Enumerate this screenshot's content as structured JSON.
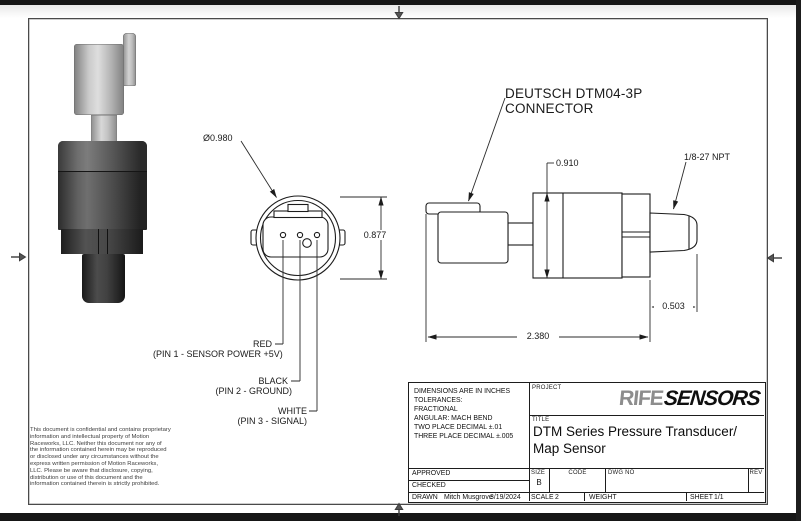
{
  "colors": {
    "line": "#1c1c1c",
    "dim_line": "#2b2b2b",
    "logo_part1": "#8d8d8d",
    "logo_part2": "#0f0f0f"
  },
  "callouts": {
    "diameter": "Ø0.980",
    "front_height": "0.877",
    "connector_line1": "DEUTSCH DTM04-3P",
    "connector_line2": "CONNECTOR",
    "body_height": "0.910",
    "thread": "1/8-27 NPT",
    "thread_length": "0.503",
    "overall_length": "2.380"
  },
  "pins": {
    "pin1_color": "RED",
    "pin1_desc": "(PIN 1 - SENSOR POWER +5V)",
    "pin2_color": "BLACK",
    "pin2_desc": "(PIN 2 - GROUND)",
    "pin3_color": "WHITE",
    "pin3_desc": "(PIN 3 - SIGNAL)"
  },
  "disclaimer": "This document is confidential and contains proprietary information and intellectual property of Motion Raceworks, LLC. Neither this document nor any of the information contained herein may be reproduced or disclosed under any circumstances without the express written permission of Motion Raceworks, LLC. Please be aware that disclosure, copying, distribution or use of this document and the information contained therein is strictly prohibited.",
  "title_block": {
    "tolerance_lines": [
      "DIMENSIONS ARE IN INCHES",
      "TOLERANCES:",
      "FRACTIONAL",
      "ANGULAR: MACH BEND",
      "TWO PLACE DECIMAL ±.01",
      "THREE PLACE DECIMAL ±.005"
    ],
    "project_label": "PROJECT",
    "logo_part1": "RIFE",
    "logo_part2": "SENSORS",
    "title_label": "TITLE",
    "title_line1": "DTM Series Pressure Transducer/",
    "title_line2": "Map Sensor",
    "approved_label": "APPROVED",
    "checked_label": "CHECKED",
    "drawn_label": "DRAWN",
    "drawn_by": "Mitch Musgrove",
    "drawn_date": "3/19/2024",
    "size_label": "SIZE",
    "size_value": "B",
    "code_label": "CODE",
    "dwg_no_label": "DWG NO",
    "rev_label": "REV",
    "scale_label": "SCALE",
    "scale_value": "2",
    "weight_label": "WEIGHT",
    "sheet_label": "SHEET",
    "sheet_value": "1/1"
  }
}
